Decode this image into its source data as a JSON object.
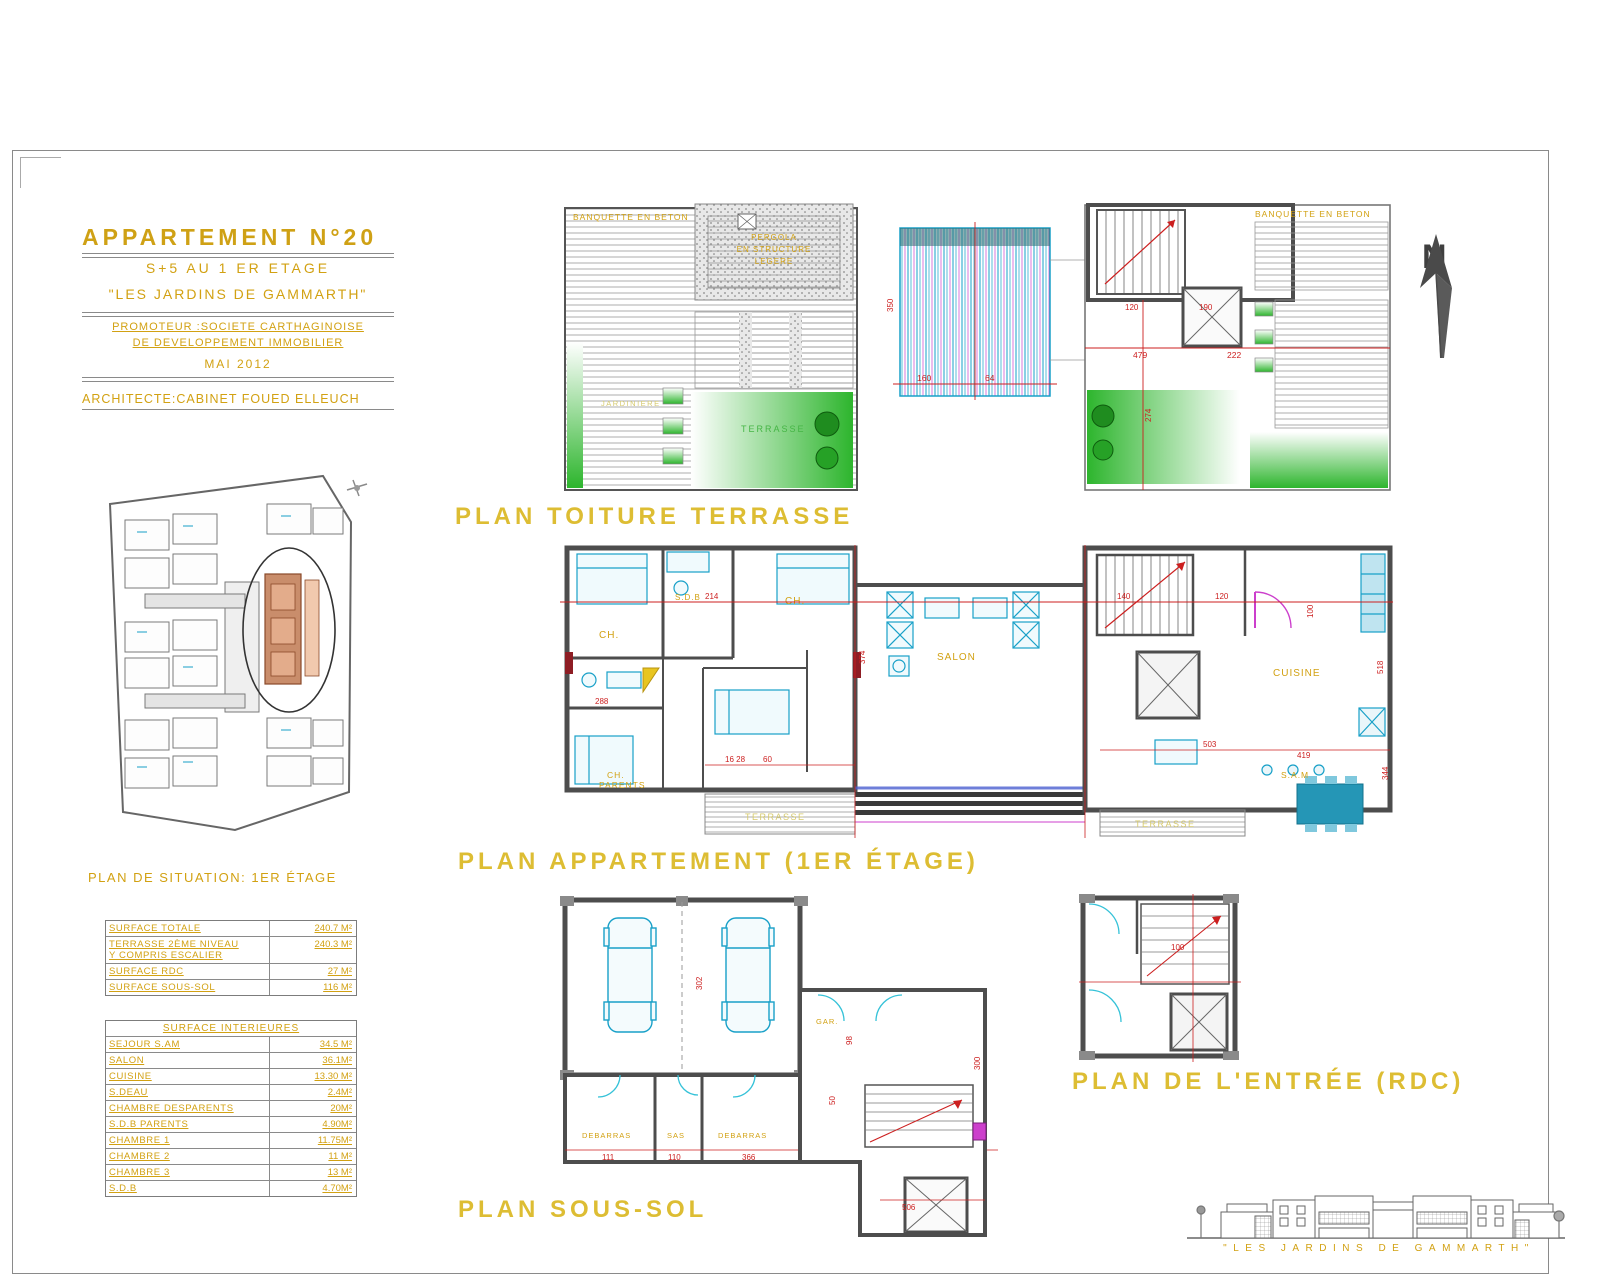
{
  "title_block": {
    "title": "APPARTEMENT N°20",
    "subtitle": "S+5 AU 1 ER ETAGE",
    "project": "\"LES JARDINS DE GAMMARTH\"",
    "promoter_line1": "PROMOTEUR :SOCIETE CARTHAGINOISE",
    "promoter_line2": "DE  DEVELOPPEMENT  IMMOBILIER",
    "date": "MAI 2012",
    "architect": "ARCHITECTE:CABINET FOUED ELLEUCH"
  },
  "compass": {
    "label": "N"
  },
  "plan_toiture": {
    "title": "PLAN TOITURE TERRASSE",
    "labels": {
      "banquette_left": "BANQUETTE EN BETON",
      "banquette_right": "BANQUETTE EN BETON",
      "pergola_1": "PERGOLA",
      "pergola_2": "EN STRUCTURE",
      "pergola_3": "LEGERE",
      "jardiniere": "JARDINIERE",
      "terrasse": "TERRASSE"
    },
    "dims": [
      "160",
      "64",
      "479",
      "222",
      "120",
      "190",
      "274",
      "350"
    ]
  },
  "plan_appartement": {
    "title": "PLAN APPARTEMENT (1ER ÉTAGE)",
    "rooms": {
      "ch1": "CH.",
      "sdb1": "S.D.B",
      "ch2": "CH.",
      "ch_parents_1": "CH.",
      "ch_parents_2": "PARENTS",
      "salon": "SALON",
      "cuisine": "CUISINE",
      "sam": "S.A.M",
      "terrasse_left": "TERRASSE",
      "terrasse_right": "TERRASSE"
    },
    "dims": [
      "214",
      "288",
      "374",
      "140",
      "120",
      "100",
      "16 28",
      "60",
      "503",
      "419",
      "518",
      "344"
    ]
  },
  "plan_sous_sol": {
    "title": "PLAN SOUS-SOL",
    "rooms": {
      "debarras1": "DEBARRAS",
      "sas": "SAS",
      "debarras2": "DEBARRAS",
      "gar": "GAR."
    },
    "dims": [
      "302",
      "111",
      "110",
      "366",
      "506",
      "98",
      "50",
      "300"
    ]
  },
  "plan_entree": {
    "title": "PLAN DE L'ENTRÉE (RDC)",
    "dims": [
      "100"
    ]
  },
  "plan_situation": {
    "title": "PLAN DE SITUATION: 1ER ÉTAGE"
  },
  "tables": {
    "surfaces": {
      "rows": [
        {
          "label": "SURFACE TOTALE",
          "value": "240.7 M²"
        },
        {
          "label": "TERRASSE 2ÈME NIVEAU",
          "label2": "Y COMPRIS ESCALIER",
          "value": "240.3 M²"
        },
        {
          "label": "SURFACE RDC",
          "value": "27 M²"
        },
        {
          "label": "SURFACE SOUS-SOL",
          "value": "116 M²"
        }
      ]
    },
    "interieures": {
      "header": "SURFACE INTERIEURES",
      "rows": [
        {
          "label": "SEJOUR S.AM",
          "value": "34.5 M²"
        },
        {
          "label": "SALON",
          "value": "36.1M²"
        },
        {
          "label": "CUISINE",
          "value": "13.30 M²"
        },
        {
          "label": "S.DEAU",
          "value": "2.4M²"
        },
        {
          "label": "CHAMBRE DESPARENTS",
          "value": "20M²"
        },
        {
          "label": "S.D.B PARENTS",
          "value": "4.90M²"
        },
        {
          "label": "CHAMBRE 1",
          "value": "11.75M²"
        },
        {
          "label": "CHAMBRE 2",
          "value": "11 M²"
        },
        {
          "label": "CHAMBRE 3",
          "value": "13 M²"
        },
        {
          "label": "S.D.B",
          "value": "4.70M²"
        }
      ]
    }
  },
  "logo": {
    "text": "\"LES JARDINS DE GAMMARTH\""
  }
}
